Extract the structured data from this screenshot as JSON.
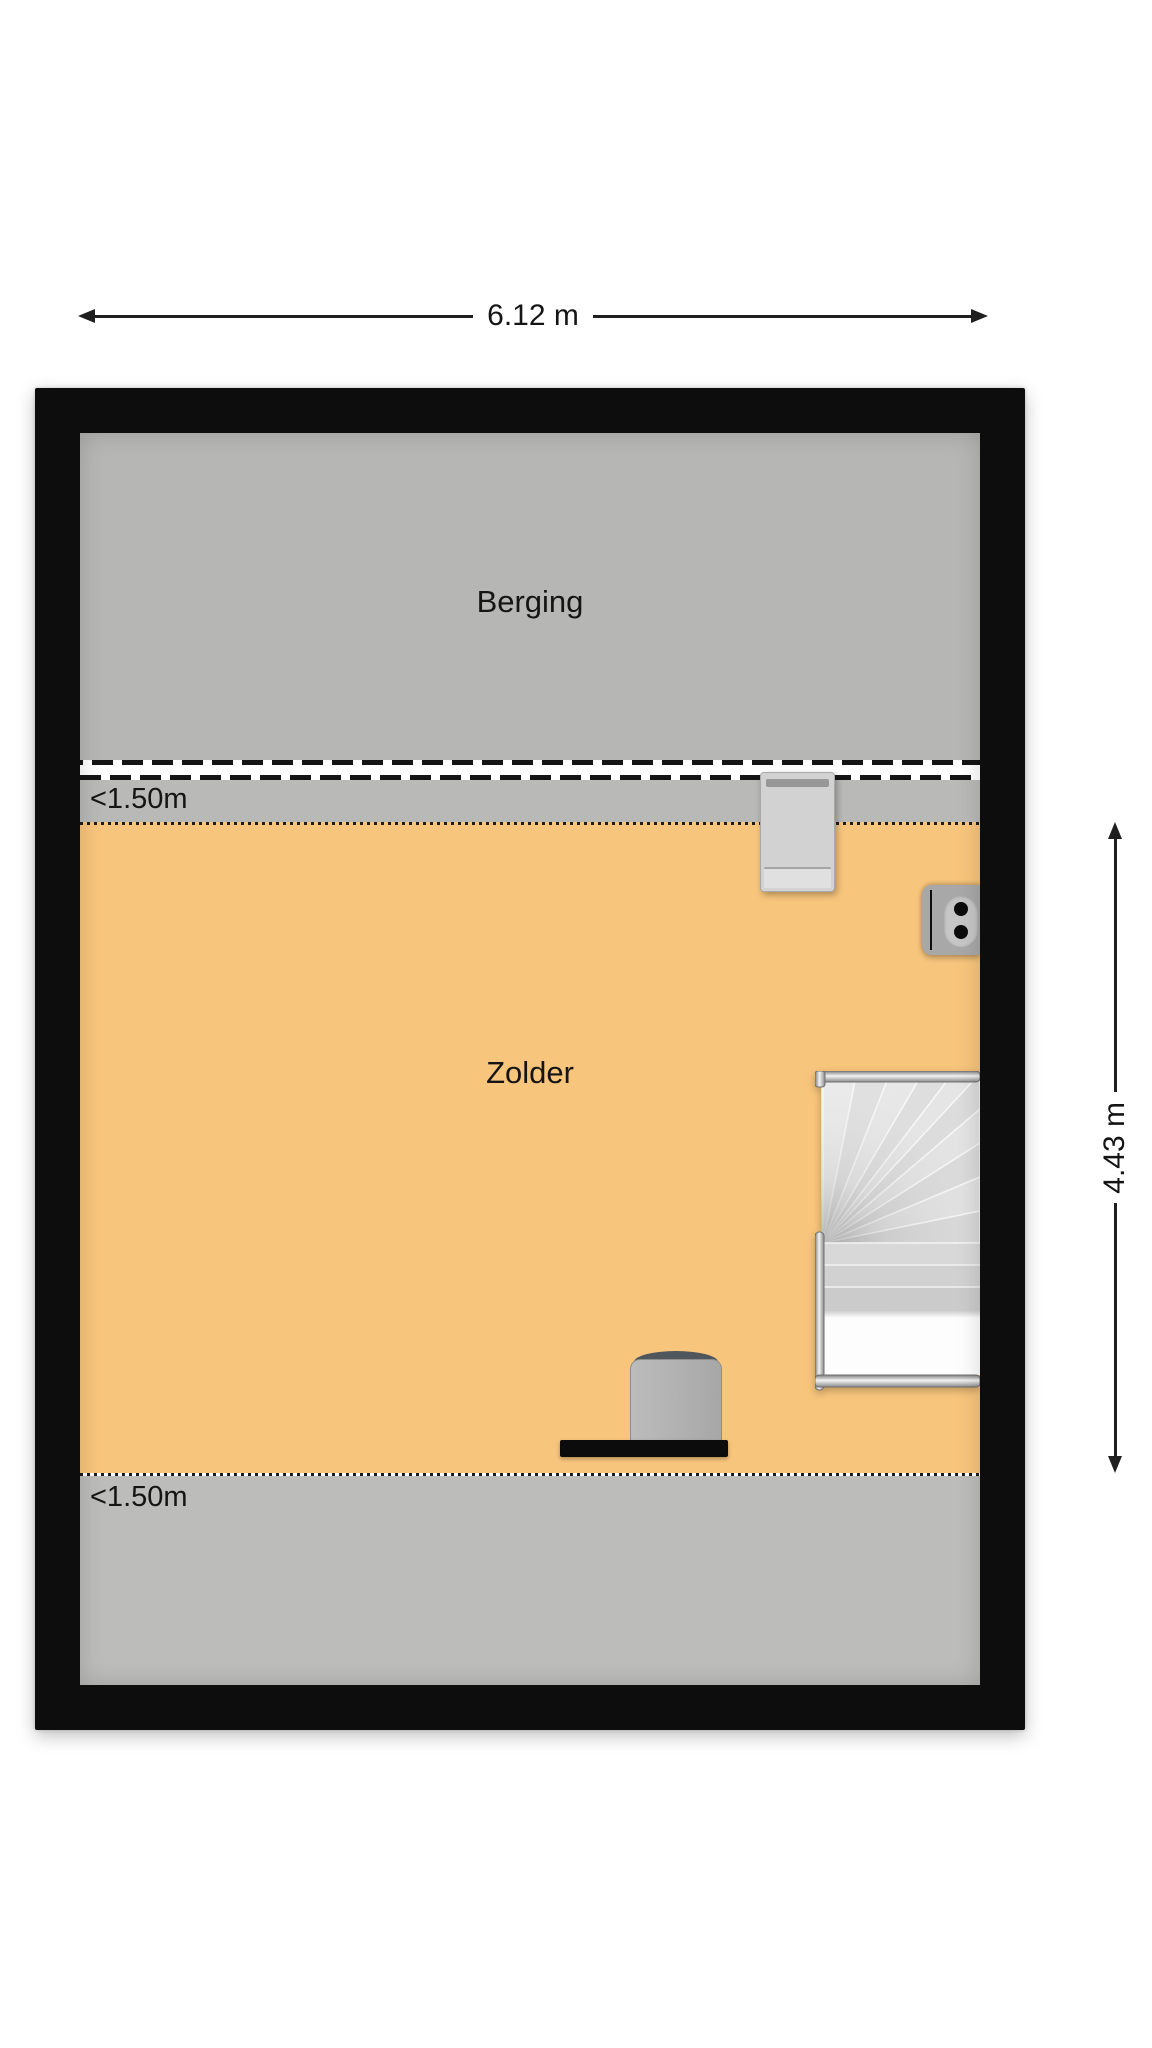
{
  "plan": {
    "rooms": [
      {
        "label": "Berging"
      },
      {
        "label": "Zolder"
      }
    ],
    "headroom": {
      "top": "<1.50m",
      "bottom": "<1.50m"
    },
    "dimensions": {
      "width": "6.12 m",
      "height": "4.43 m"
    },
    "furniture": [
      {
        "name": "cabinet"
      },
      {
        "name": "power-outlet"
      },
      {
        "name": "staircase"
      },
      {
        "name": "desk"
      },
      {
        "name": "office-chair"
      }
    ],
    "colors": {
      "wall": "#0d0d0d",
      "berging_floor": "#b6b6b4",
      "zolder_floor": "#f8c57c",
      "headroom_strip": "#bcbcba",
      "stair_tread": "#e3e3e3",
      "dimension_line": "#1f1f1f",
      "background": "#ffffff"
    }
  }
}
